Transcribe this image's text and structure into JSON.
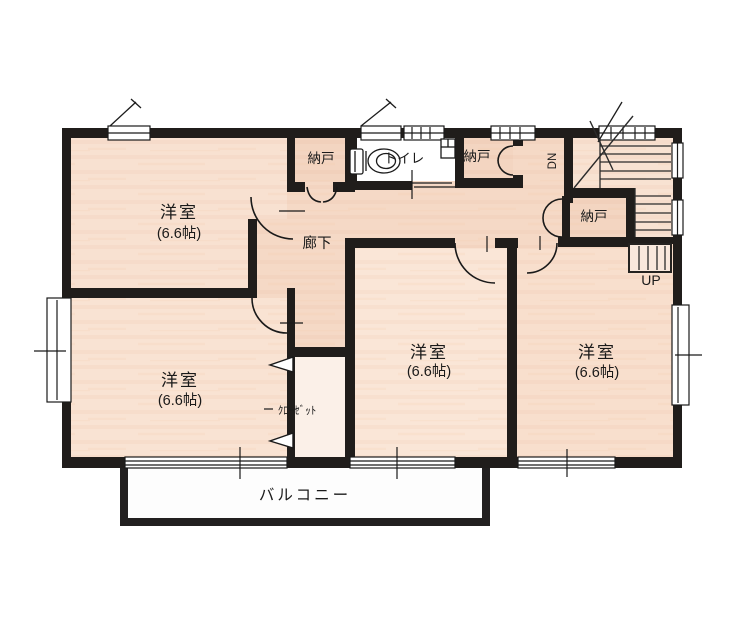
{
  "plan": {
    "rooms": {
      "bedroom_nw": {
        "label": "洋室",
        "size": "(6.6帖)"
      },
      "bedroom_sw": {
        "label": "洋室",
        "size": "(6.6帖)"
      },
      "bedroom_center": {
        "label": "洋室",
        "size": "(6.6帖)"
      },
      "bedroom_se": {
        "label": "洋室",
        "size": "(6.6帖)"
      },
      "storage_nw": {
        "label": "納戸"
      },
      "storage_ne": {
        "label": "納戸"
      },
      "storage_stair": {
        "label": "納戸"
      },
      "toilet": {
        "label": "トイレ"
      },
      "hallway": {
        "label": "廊下"
      },
      "closet": {
        "label": "ｸﾛｰｾﾞｯﾄ"
      },
      "balcony": {
        "label": "バルコニー"
      }
    },
    "stairs": {
      "up_label": "UP",
      "down_label": "DN"
    }
  },
  "colors": {
    "wall": "#201d1b",
    "text": "#191919",
    "room_fill": "#f5d9c6",
    "paper": "#ffffff"
  }
}
